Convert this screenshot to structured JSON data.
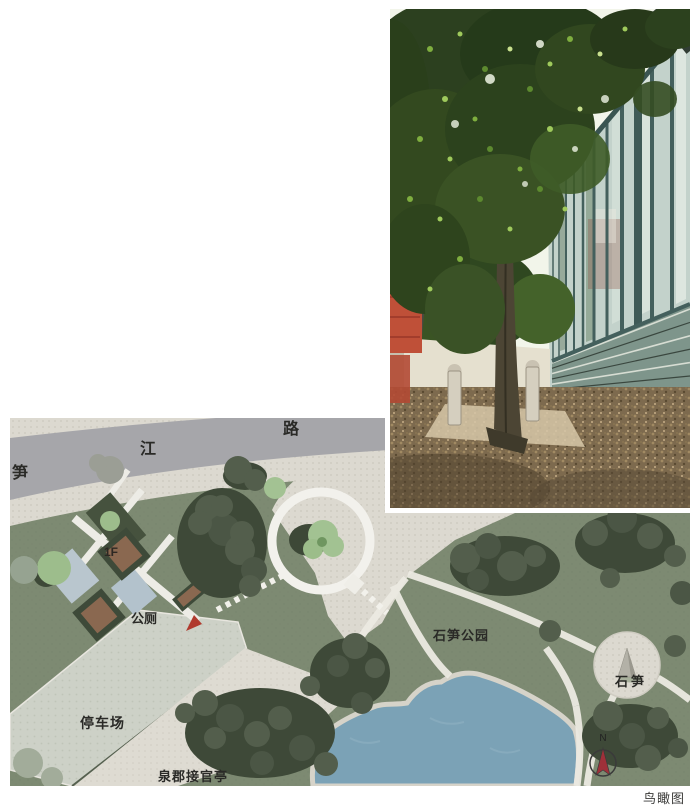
{
  "caption": "鸟瞰图",
  "plan": {
    "road_name": [
      "笋",
      "江",
      "路"
    ],
    "labels": {
      "floor": "1F",
      "toilet": "公厕",
      "parking": "停车场",
      "pavilion": "泉郡接官亭",
      "park_name": "石笋公园",
      "stone": "石笋"
    },
    "compass_north": "N",
    "colors": {
      "park_green": "#7d8a72",
      "road_gray": "#a6a6aa",
      "pavement": "#dcd9d0",
      "pond_blue": "#7ba2b6",
      "marker_red": "#b03a2e",
      "compass_red": "#9e3039"
    }
  }
}
